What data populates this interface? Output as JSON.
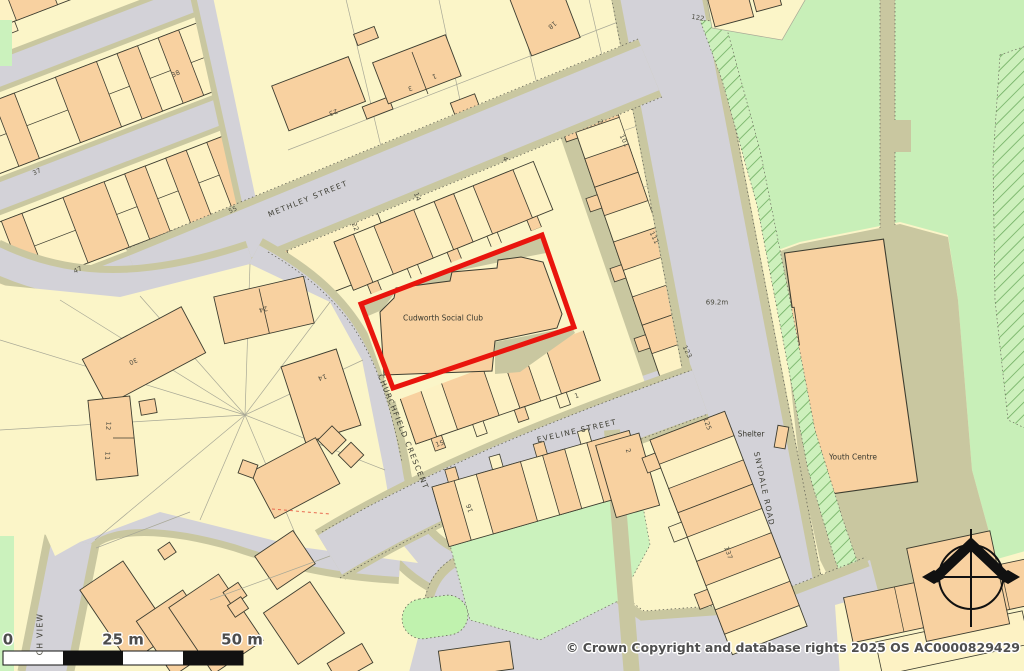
{
  "highlight": {
    "label": "Cudworth Social Club",
    "border_color": "#e9150d"
  },
  "annotations": {
    "youth_centre": "Youth Centre",
    "shelter": "Shelter",
    "spot_height": "69.2m"
  },
  "street_labels": [
    {
      "text": "METHLEY STREET",
      "x": 308,
      "y": 199,
      "rot": -22
    },
    {
      "text": "EVELINE STREET",
      "x": 577,
      "y": 431,
      "rot": -13
    },
    {
      "text": "CHURCHFIELD CRESCENT",
      "x": 403,
      "y": 432,
      "rot": 68
    },
    {
      "text": "SNYDALE ROAD",
      "x": 764,
      "y": 489,
      "rot": 78
    },
    {
      "text": "CH VIEW",
      "x": 40,
      "y": 634,
      "rot": -90
    }
  ],
  "house_numbers": [
    {
      "text": "38",
      "x": 176,
      "y": 74,
      "rot": -25
    },
    {
      "text": "37",
      "x": 37,
      "y": 172,
      "rot": -25
    },
    {
      "text": "55",
      "x": 233,
      "y": 210,
      "rot": -25
    },
    {
      "text": "47",
      "x": 78,
      "y": 270,
      "rot": -25
    },
    {
      "text": "23",
      "x": 333,
      "y": 112,
      "rot": 160
    },
    {
      "text": "3",
      "x": 410,
      "y": 88,
      "rot": 160
    },
    {
      "text": "1",
      "x": 434,
      "y": 76,
      "rot": 160
    },
    {
      "text": "18",
      "x": 552,
      "y": 25,
      "rot": 140
    },
    {
      "text": "122",
      "x": 698,
      "y": 18,
      "rot": 10
    },
    {
      "text": "22",
      "x": 355,
      "y": 227,
      "rot": 68
    },
    {
      "text": "14",
      "x": 417,
      "y": 197,
      "rot": 68
    },
    {
      "text": "4",
      "x": 505,
      "y": 159,
      "rot": 68
    },
    {
      "text": "2",
      "x": 600,
      "y": 122,
      "rot": 64
    },
    {
      "text": "101",
      "x": 624,
      "y": 141,
      "rot": 64
    },
    {
      "text": "111",
      "x": 654,
      "y": 238,
      "rot": 64
    },
    {
      "text": "123",
      "x": 687,
      "y": 352,
      "rot": 64
    },
    {
      "text": "15",
      "x": 440,
      "y": 444,
      "rot": -18
    },
    {
      "text": "1",
      "x": 577,
      "y": 396,
      "rot": -18
    },
    {
      "text": "16",
      "x": 470,
      "y": 508,
      "rot": -108
    },
    {
      "text": "2",
      "x": 628,
      "y": 451,
      "rot": 70
    },
    {
      "text": "125",
      "x": 707,
      "y": 424,
      "rot": 70
    },
    {
      "text": "137",
      "x": 728,
      "y": 553,
      "rot": 70
    },
    {
      "text": "24",
      "x": 263,
      "y": 309,
      "rot": 165
    },
    {
      "text": "30",
      "x": 133,
      "y": 361,
      "rot": 155
    },
    {
      "text": "14",
      "x": 322,
      "y": 377,
      "rot": 160
    },
    {
      "text": "12",
      "x": 108,
      "y": 426,
      "rot": 95
    },
    {
      "text": "11",
      "x": 107,
      "y": 456,
      "rot": 95
    }
  ],
  "scale_bar": {
    "labels": [
      {
        "text": "0",
        "x": 8,
        "y": 640
      },
      {
        "text": "25 m",
        "x": 123,
        "y": 640
      },
      {
        "text": "50 m",
        "x": 242,
        "y": 640
      }
    ]
  },
  "copyright": "© Crown Copyright and database rights 2025 OS AC0000829429",
  "icons": {
    "north_arrow": "compass-north-arrow"
  },
  "palette": {
    "parcel_cream": "#fbf5c8",
    "building_orange": "#f8d1a0",
    "building_cream": "#fdf2c4",
    "road_gray": "#d3d2d8",
    "verge_khaki": "#c9c7a0",
    "park_green": "#c8efb8",
    "garden_green": "#cbf2bd",
    "highlight_red": "#e9150d"
  }
}
